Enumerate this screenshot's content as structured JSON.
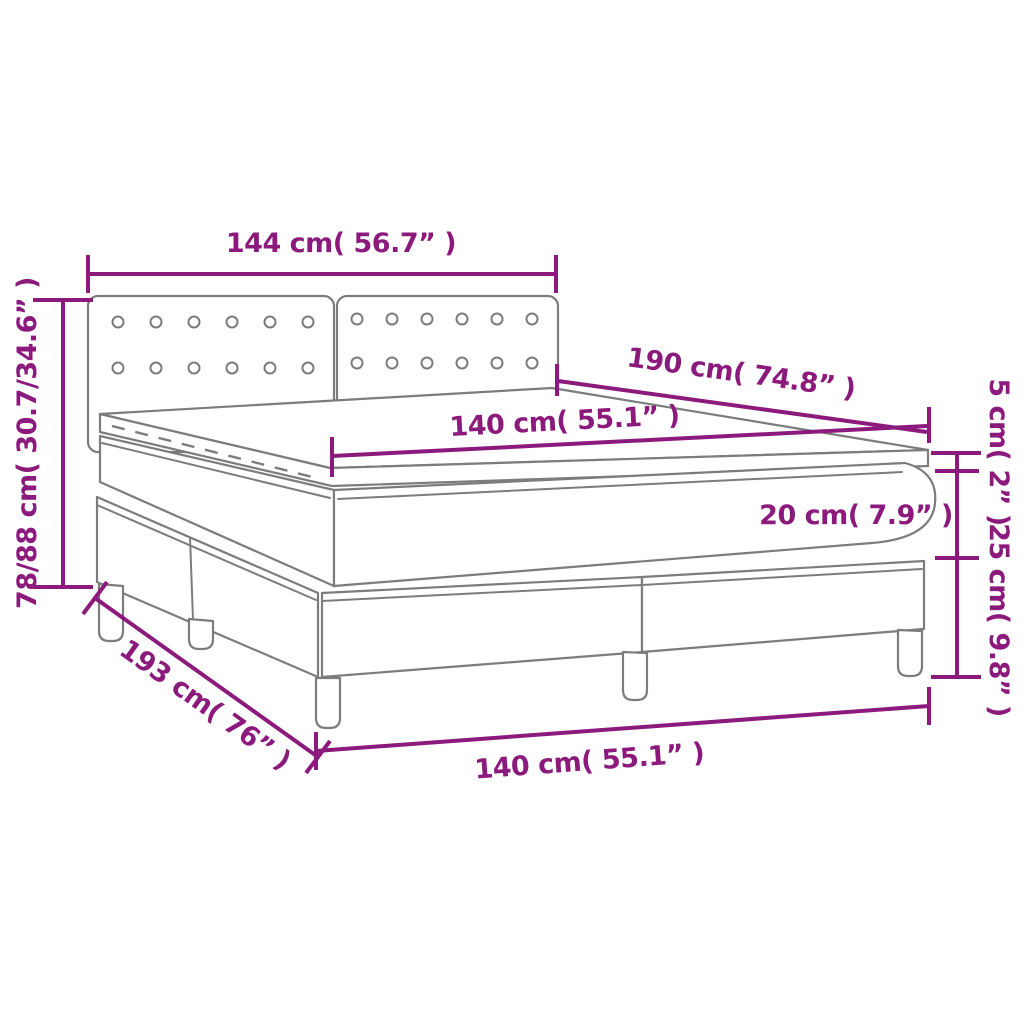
{
  "page": {
    "type": "product dimension diagram",
    "subject": "box spring bed with tufted headboard, mattress and topper",
    "background": "#ffffff"
  },
  "colors": {
    "dimension_accent": "#8b1a7c",
    "drawing_outline": "#7c7c7c"
  },
  "dimensions": {
    "headboard_width": {
      "label": "144 cm( 56.7” )",
      "cm": "144",
      "in": "56.7"
    },
    "bed_height": {
      "label": "78/88 cm( 30.7/34.6” )",
      "cm": "78/88",
      "in": "30.7/34.6"
    },
    "mattress_length": {
      "label": "190 cm( 74.8” )",
      "cm": "190",
      "in": "74.8"
    },
    "mattress_width": {
      "label": "140 cm( 55.1” )",
      "cm": "140",
      "in": "55.1"
    },
    "topper_height": {
      "label": "5 cm( 2” )",
      "cm": "5",
      "in": "2"
    },
    "mattress_height": {
      "label": "20 cm( 7.9” )",
      "cm": "20",
      "in": "7.9"
    },
    "base_height": {
      "label": "25 cm( 9.8” )",
      "cm": "25",
      "in": "9.8"
    },
    "bed_length": {
      "label": "193 cm( 76” )",
      "cm": "193",
      "in": "76"
    },
    "base_width": {
      "label": "140 cm( 55.1” )",
      "cm": "140",
      "in": "55.1"
    }
  }
}
